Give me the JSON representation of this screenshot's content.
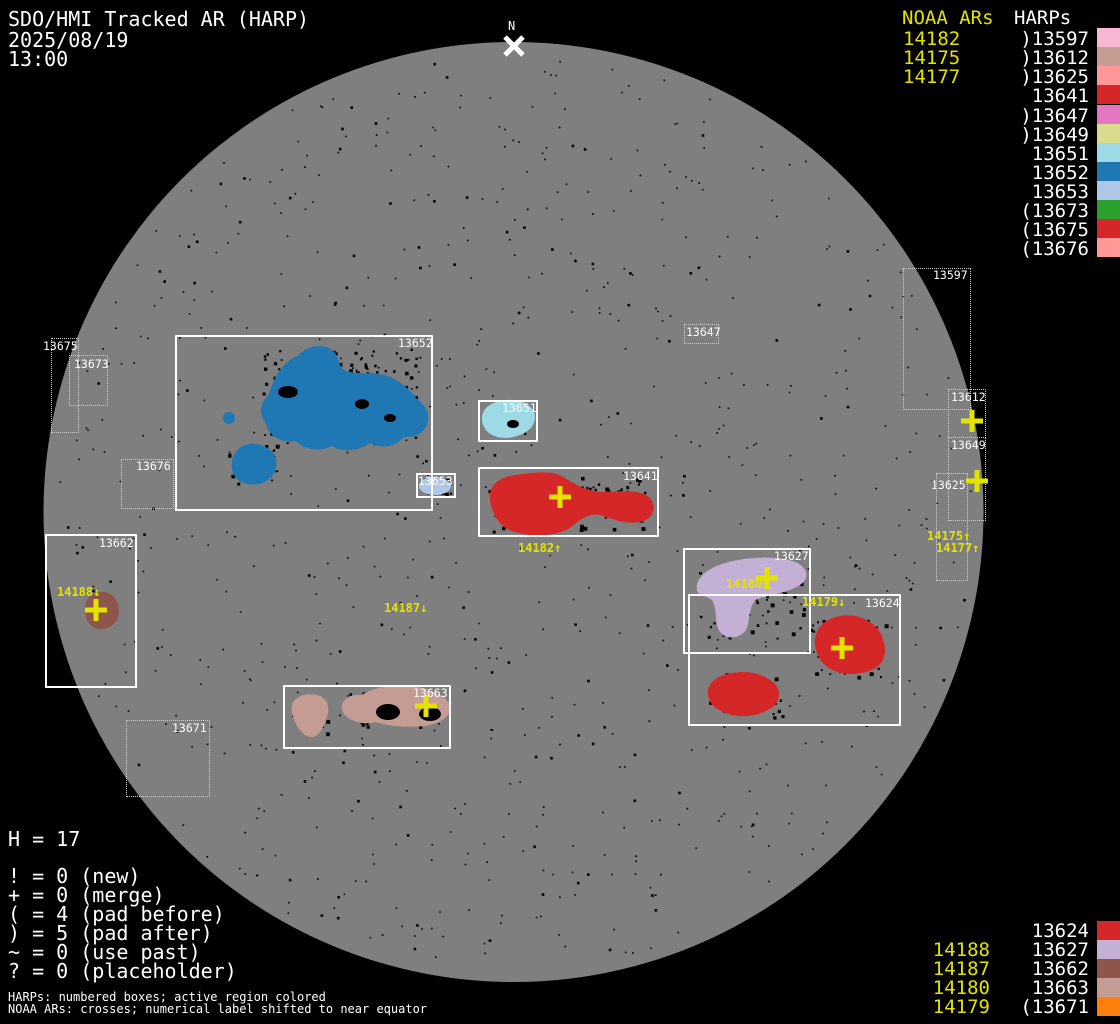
{
  "header": {
    "title": "SDO/HMI Tracked AR (HARP)",
    "date": "2025/08/19",
    "time": "13:00"
  },
  "north_marker": {
    "label": "N"
  },
  "colors": {
    "background": "#000000",
    "disk": "#7f7f7f",
    "noaa_yellow": "#e3e300",
    "box_white": "#ffffff"
  },
  "legend_top": {
    "noaa_header": "NOAA ARs",
    "harp_header": "HARPs",
    "noaa_items": [
      "14182",
      "14175",
      "14177"
    ],
    "harp_items": [
      {
        "prefix": ")",
        "num": "13597",
        "color": "#f7b6d2"
      },
      {
        "prefix": ")",
        "num": "13612",
        "color": "#c49c94"
      },
      {
        "prefix": ")",
        "num": "13625",
        "color": "#ff9896"
      },
      {
        "prefix": "",
        "num": "13641",
        "color": "#d62728"
      },
      {
        "prefix": ")",
        "num": "13647",
        "color": "#e377c2"
      },
      {
        "prefix": ")",
        "num": "13649",
        "color": "#dbdb8d"
      },
      {
        "prefix": "",
        "num": "13651",
        "color": "#9edae5"
      },
      {
        "prefix": "",
        "num": "13652",
        "color": "#1f77b4"
      },
      {
        "prefix": "",
        "num": "13653",
        "color": "#aec7e8"
      },
      {
        "prefix": "(",
        "num": "13673",
        "color": "#2ca02c"
      },
      {
        "prefix": "(",
        "num": "13675",
        "color": "#d62728"
      },
      {
        "prefix": "(",
        "num": "13676",
        "color": "#ff9896"
      }
    ]
  },
  "legend_bottom_right": {
    "rows": [
      {
        "noaa": "",
        "harp": "13624",
        "color": "#d62728"
      },
      {
        "noaa": "14188",
        "harp": "13627",
        "color": "#c5b0d5"
      },
      {
        "noaa": "14187",
        "harp": "13662",
        "color": "#8c564b"
      },
      {
        "noaa": "14180",
        "harp": "13663",
        "color": "#c49c94"
      },
      {
        "noaa": "14179",
        "harp": "(13671",
        "color": "#ff7f0e"
      }
    ]
  },
  "stats": {
    "harp_count": "H = 17",
    "symbols": [
      "! = 0 (new)",
      "+ = 0 (merge)",
      "( = 4 (pad before)",
      ") = 5 (pad after)",
      "~ = 0 (use past)",
      "? = 0 (placeholder)"
    ]
  },
  "footnotes": [
    "HARPs: numbered boxes; active region colored",
    "NOAA ARs: crosses; numerical label shifted to near equator"
  ],
  "harp_boxes": [
    {
      "label": "13652",
      "style": "solid"
    },
    {
      "label": "13653",
      "style": "solid"
    },
    {
      "label": "13651",
      "style": "solid"
    },
    {
      "label": "13641",
      "style": "solid"
    },
    {
      "label": "13662",
      "style": "solid"
    },
    {
      "label": "13663",
      "style": "solid"
    },
    {
      "label": "13627",
      "style": "solid"
    },
    {
      "label": "13624",
      "style": "solid"
    },
    {
      "label": "13675",
      "style": "dotted"
    },
    {
      "label": "13673",
      "style": "dotted"
    },
    {
      "label": "13676",
      "style": "dotted"
    },
    {
      "label": "13671",
      "style": "dotted"
    },
    {
      "label": "13647",
      "style": "dotted"
    },
    {
      "label": "13597",
      "style": "dotted"
    },
    {
      "label": "13612",
      "style": "dotted"
    },
    {
      "label": "13649",
      "style": "dotted"
    },
    {
      "label": "13625",
      "style": "dotted"
    }
  ],
  "disk_labels": [
    {
      "text": "14182↑"
    },
    {
      "text": "14188↓"
    },
    {
      "text": "14187↓"
    },
    {
      "text": "14180↓"
    },
    {
      "text": "14179↓"
    },
    {
      "text": "14175↑"
    },
    {
      "text": "14177↑"
    }
  ],
  "regions": {
    "r13652": {
      "color": "#1f77b4"
    },
    "r13651": {
      "color": "#9edae5"
    },
    "r13653": {
      "color": "#aec7e8"
    },
    "r13641": {
      "color": "#d62728"
    },
    "r13662": {
      "color": "#8c564b"
    },
    "r13663": {
      "color": "#c49c94"
    },
    "r13627": {
      "color": "#c5b0d5"
    },
    "r13624": {
      "color": "#d62728"
    }
  },
  "chart_data": {
    "type": "scatter",
    "title": "SDO/HMI Tracked AR (HARP)",
    "datetime": "2025/08/19 13:00",
    "harp_total": 17,
    "noaa_ars": [
      "14182",
      "14175",
      "14177",
      "14188",
      "14187",
      "14180",
      "14179"
    ],
    "harps": [
      {
        "num": "13597",
        "pad": "after",
        "color": "#f7b6d2"
      },
      {
        "num": "13612",
        "pad": "after",
        "color": "#c49c94"
      },
      {
        "num": "13624",
        "pad": "none",
        "color": "#d62728"
      },
      {
        "num": "13625",
        "pad": "after",
        "color": "#ff9896"
      },
      {
        "num": "13627",
        "pad": "none",
        "color": "#c5b0d5"
      },
      {
        "num": "13641",
        "pad": "none",
        "color": "#d62728"
      },
      {
        "num": "13647",
        "pad": "after",
        "color": "#e377c2"
      },
      {
        "num": "13649",
        "pad": "after",
        "color": "#dbdb8d"
      },
      {
        "num": "13651",
        "pad": "none",
        "color": "#9edae5"
      },
      {
        "num": "13652",
        "pad": "none",
        "color": "#1f77b4"
      },
      {
        "num": "13653",
        "pad": "none",
        "color": "#aec7e8"
      },
      {
        "num": "13662",
        "pad": "none",
        "color": "#8c564b"
      },
      {
        "num": "13663",
        "pad": "none",
        "color": "#c49c94"
      },
      {
        "num": "13671",
        "pad": "before",
        "color": "#ff7f0e"
      },
      {
        "num": "13673",
        "pad": "before",
        "color": "#2ca02c"
      },
      {
        "num": "13675",
        "pad": "before",
        "color": "#d62728"
      },
      {
        "num": "13676",
        "pad": "before",
        "color": "#ff9896"
      }
    ],
    "counters": {
      "new": 0,
      "merge": 0,
      "pad_before": 4,
      "pad_after": 5,
      "use_past": 0,
      "placeholder": 0
    }
  }
}
